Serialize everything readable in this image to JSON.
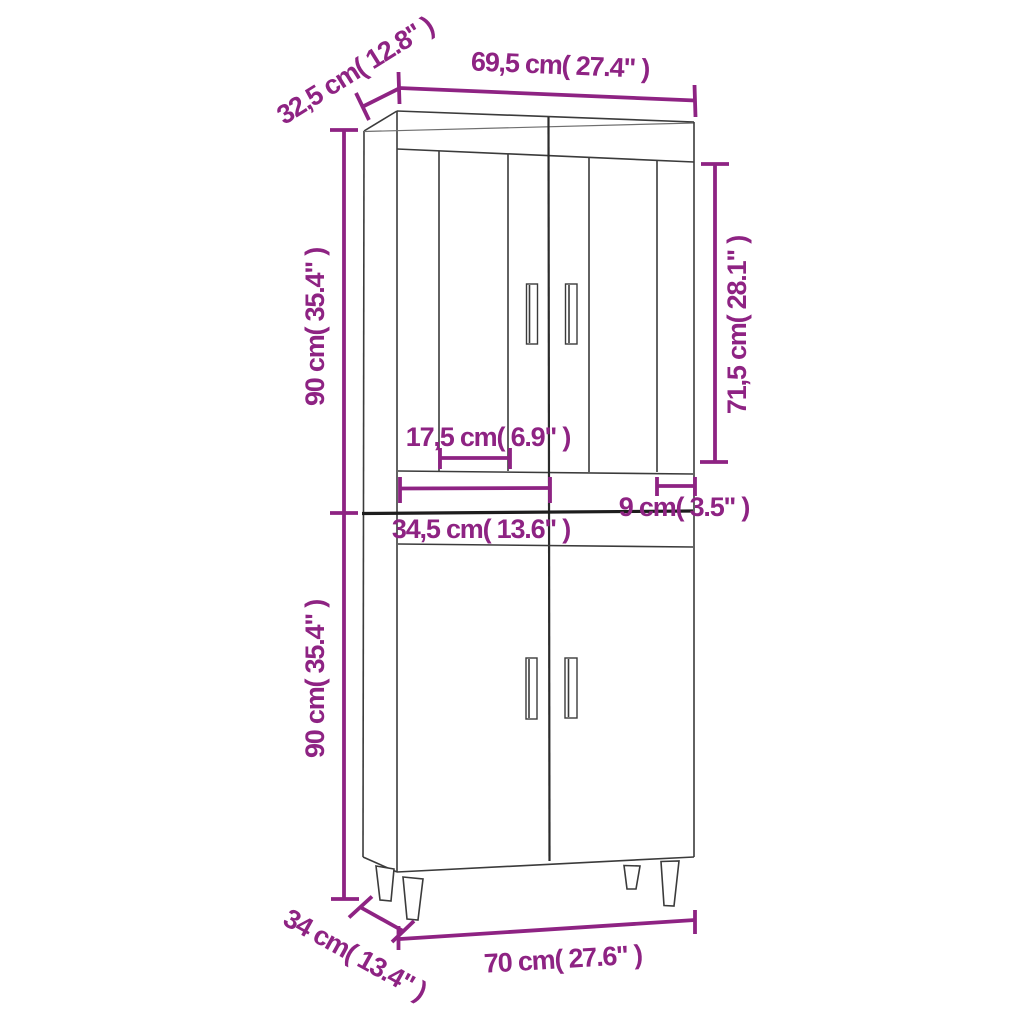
{
  "colors": {
    "dimension": "#8e2383",
    "outline": "#3b3b3b",
    "background": "#ffffff"
  },
  "labels": {
    "top_depth": "32,5 cm( 12.8\" )",
    "top_width": "69,5 cm( 27.4\" )",
    "upper_section_height": "90 cm( 35.4\" )",
    "door_height": "71,5 cm( 28.1\" )",
    "door_panel_width": "17,5 cm( 6.9\" )",
    "half_front_width": "34,5 cm( 13.6\" )",
    "right_stile_width": "9 cm( 3.5\" )",
    "lower_section_height": "90 cm( 35.4\" )",
    "base_depth": "34 cm( 13.4\" )",
    "base_width": "70 cm( 27.6\" )"
  }
}
